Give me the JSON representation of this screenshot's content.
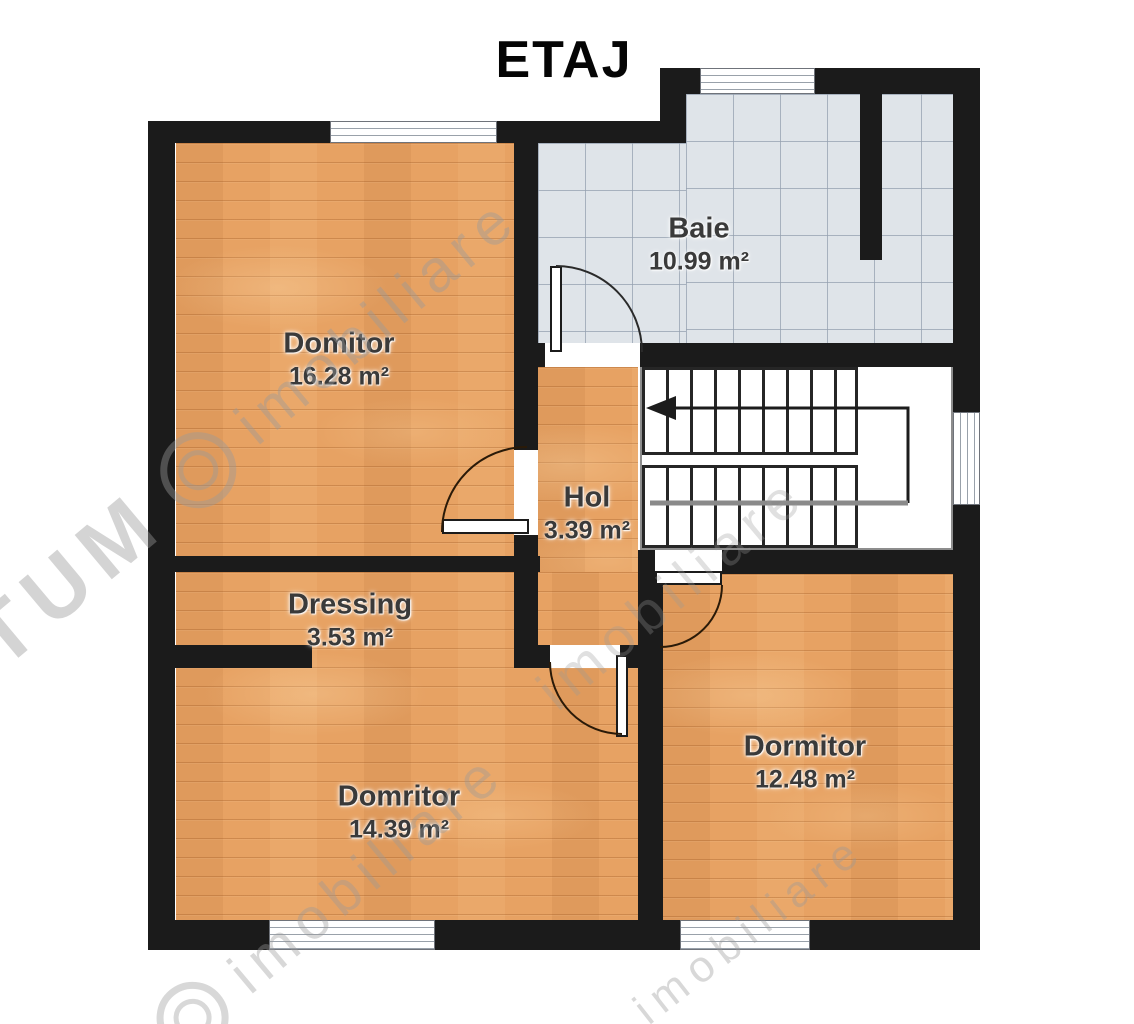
{
  "title": "ETAJ",
  "rooms": [
    {
      "name": "Domitor",
      "area": "16.28 m²"
    },
    {
      "name": "Baie",
      "area": "10.99 m²"
    },
    {
      "name": "Hol",
      "area": "3.39 m²"
    },
    {
      "name": "Dressing",
      "area": "3.53 m²"
    },
    {
      "name": "Domritor",
      "area": "14.39 m²"
    },
    {
      "name": "Dormitor",
      "area": "12.48 m²"
    }
  ],
  "stairs": {
    "walk_line_arrow": "arrow-left"
  },
  "watermark": {
    "logo_text": "TUM",
    "brand": "imobiliare"
  },
  "colors": {
    "wall": "#1b1b1b",
    "wood_floor": "#e7a263",
    "tile_floor": "#dfe4e9",
    "stair_floor": "#ffffff",
    "title": "#050505",
    "label": "#3a3a3a",
    "watermark": "#9a9a9a"
  }
}
